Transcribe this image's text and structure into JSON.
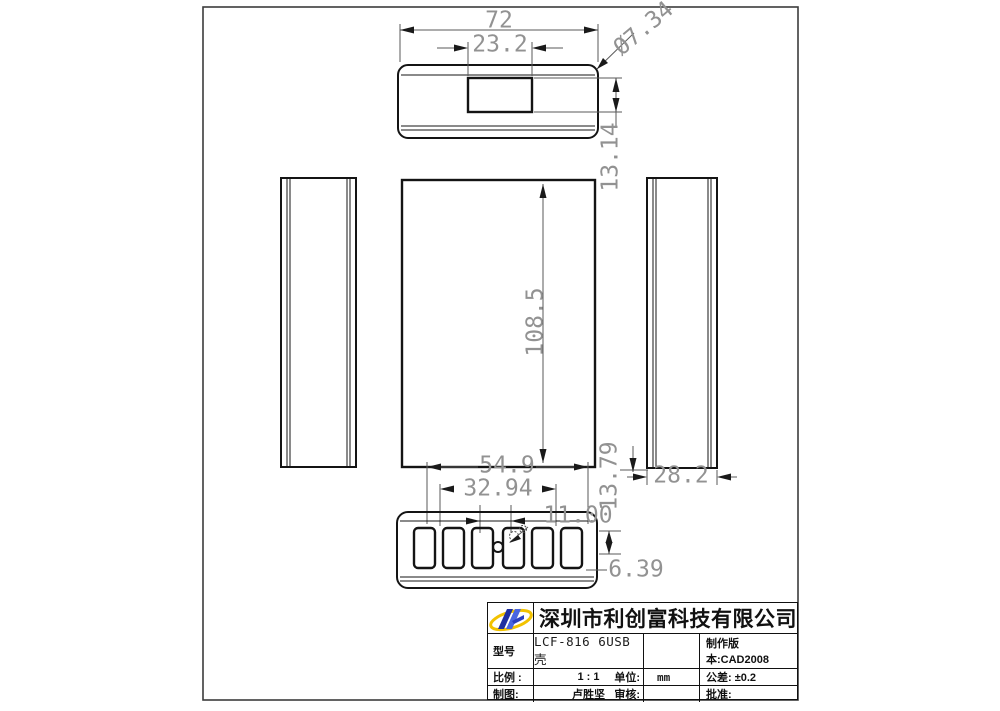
{
  "drawing": {
    "dims": {
      "top_width": "72",
      "screen_width": "23.2",
      "corner_diameter": "Ø7.34",
      "screen_height": "13.14",
      "body_height": "108.5",
      "ports_span": "54.9",
      "ports_inner_span": "32.94",
      "port_pitch": "11.00",
      "bottom_offset": "13.79",
      "side_width": "28.2",
      "port_edge_offset": "6.39"
    }
  },
  "title_block": {
    "company": "深圳市利创富科技有限公司",
    "model_label": "型号",
    "model_value": "LCF-816 6USB壳",
    "version": "制作版本:CAD2008",
    "scale_label": "比例 :",
    "scale_value": "1 : 1",
    "unit_label": "单位:",
    "unit_value": "mm",
    "tolerance": "公差: ±0.2",
    "drawn_by_label": "制图:",
    "drawn_by_value": "卢胜坚",
    "checked_label": "审核:",
    "approved_label": "批准:"
  }
}
